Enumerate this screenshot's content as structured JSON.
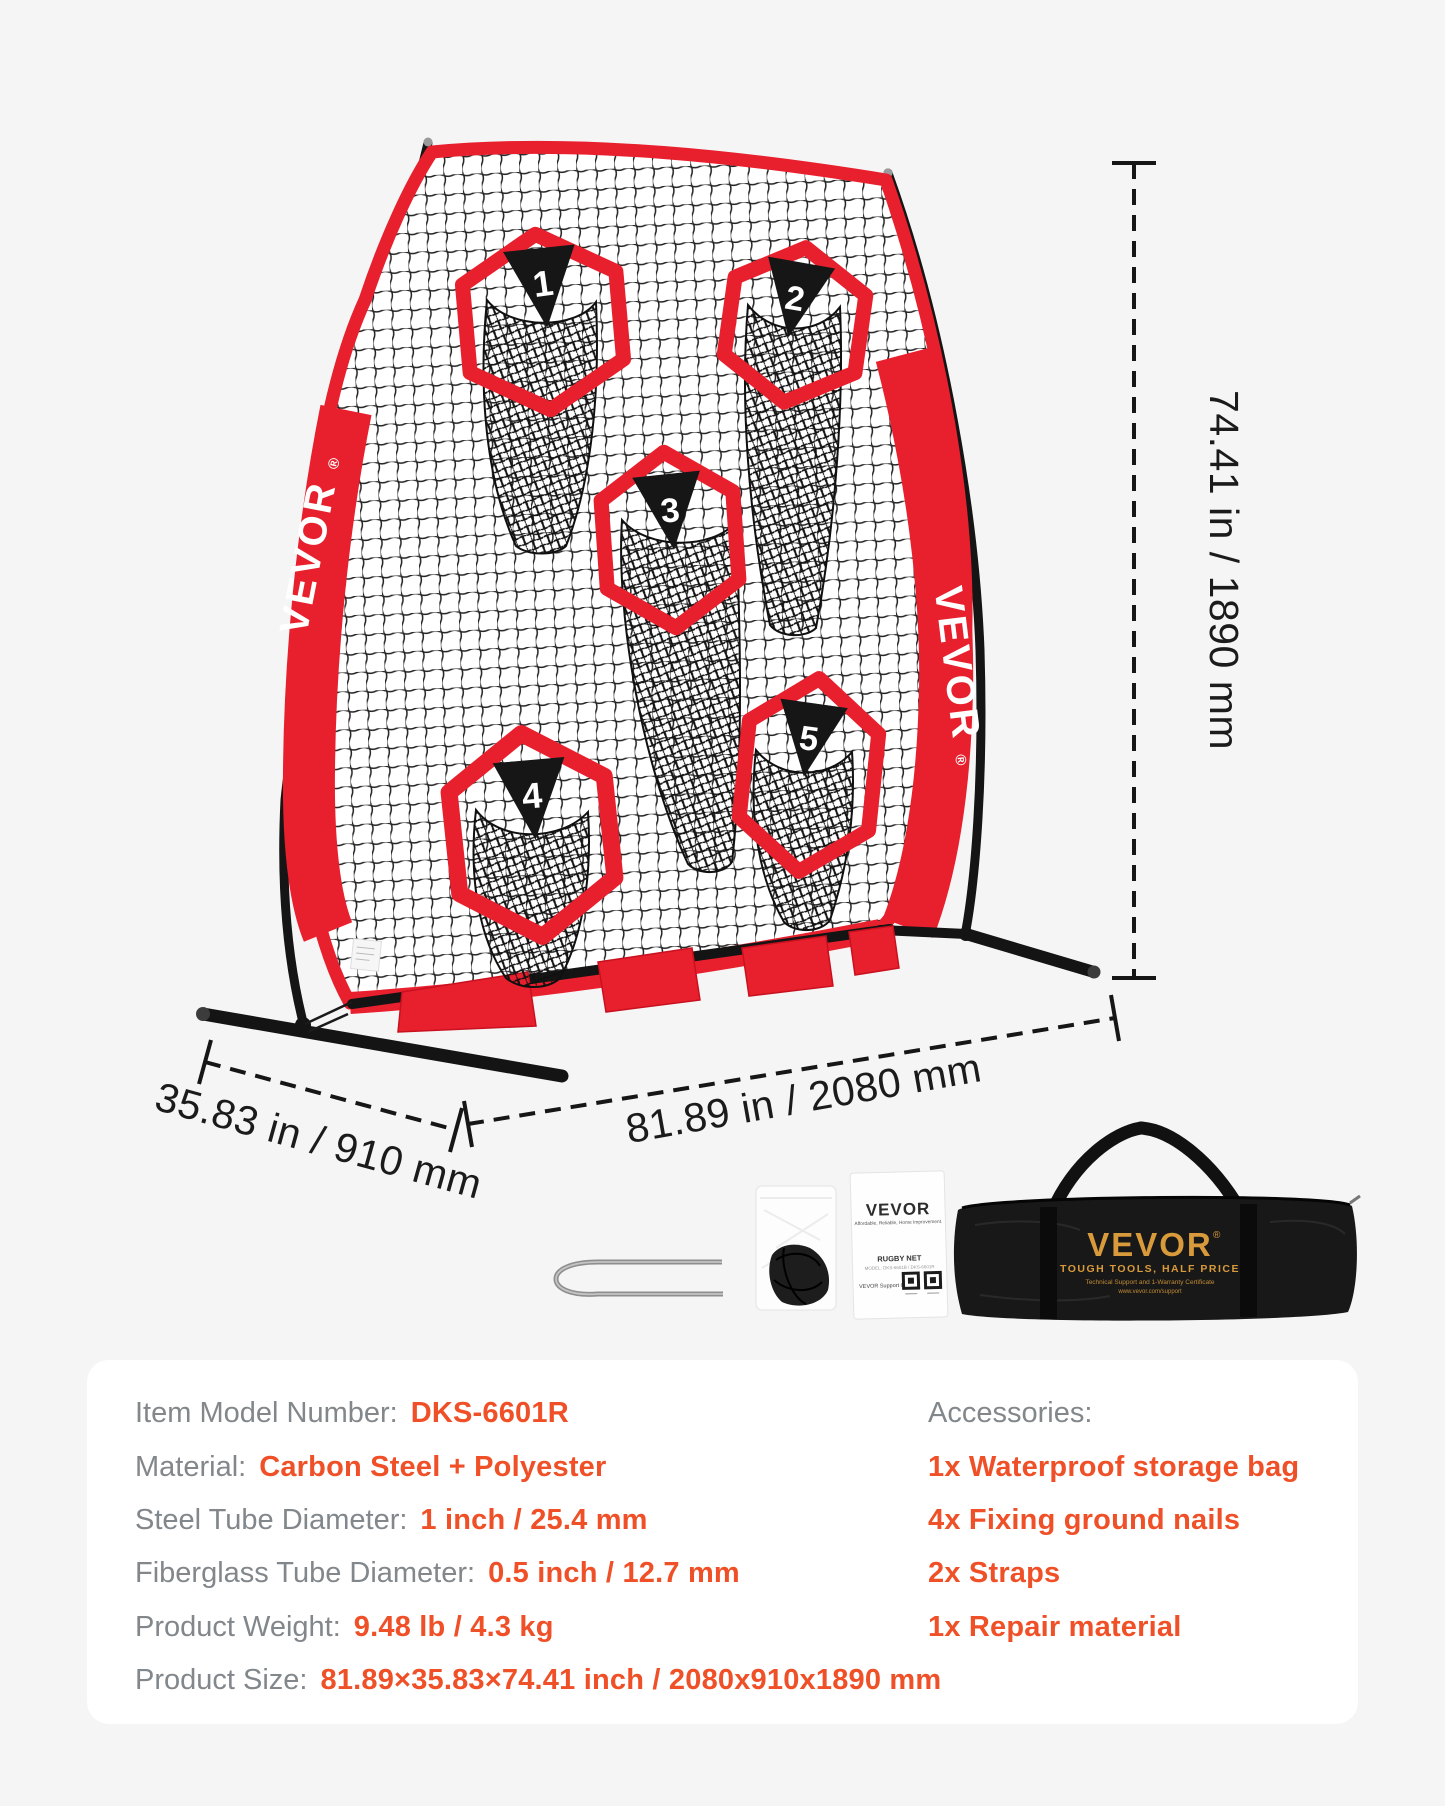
{
  "brand": {
    "name": "VEVOR",
    "registered": "®"
  },
  "targets": {
    "numbers": [
      "1",
      "2",
      "3",
      "4",
      "5"
    ]
  },
  "dimensions": {
    "height": "74.41 in / 1890 mm",
    "width": "81.89 in / 2080 mm",
    "depth": "35.83 in / 910 mm"
  },
  "accessories_row": {
    "manual": {
      "brand": "VEVOR",
      "tagline": "Affordable, Reliable, Home Improvement.",
      "product": "RUGBY NET",
      "model_line": "MODEL: DKS-6601B / DKS-6601R",
      "support": "VEVOR Support Center"
    },
    "bag": {
      "brand": "VEVOR",
      "registered": "®",
      "line1": "TOUGH TOOLS, HALF PRICE",
      "line2": "Technical Support and 1-Warranty Certificate",
      "line3": "www.vevor.com/support"
    }
  },
  "specs": {
    "rows": [
      {
        "label": "Item Model Number:",
        "value": "DKS-6601R"
      },
      {
        "label": "Material:",
        "value": "Carbon Steel + Polyester"
      },
      {
        "label": "Steel Tube Diameter:",
        "value": "1 inch / 25.4 mm"
      },
      {
        "label": "Fiberglass Tube Diameter:",
        "value": "0.5 inch / 12.7 mm"
      },
      {
        "label": "Product Weight:",
        "value": "9.48 lb / 4.3 kg"
      },
      {
        "label": "Product Size:",
        "value": "81.89×35.83×74.41 inch / 2080x910x1890 mm"
      }
    ],
    "accessories": {
      "title": "Accessories:",
      "items": [
        "1x Waterproof storage bag",
        "4x Fixing ground nails",
        "2x Straps",
        "1x Repair material"
      ]
    }
  },
  "colors": {
    "red": "#e8202d",
    "red_dark": "#c9101f",
    "orange": "#ef5027",
    "label_gray": "#82878b",
    "ink": "#1b1b1b",
    "gold": "#d99a3c"
  }
}
